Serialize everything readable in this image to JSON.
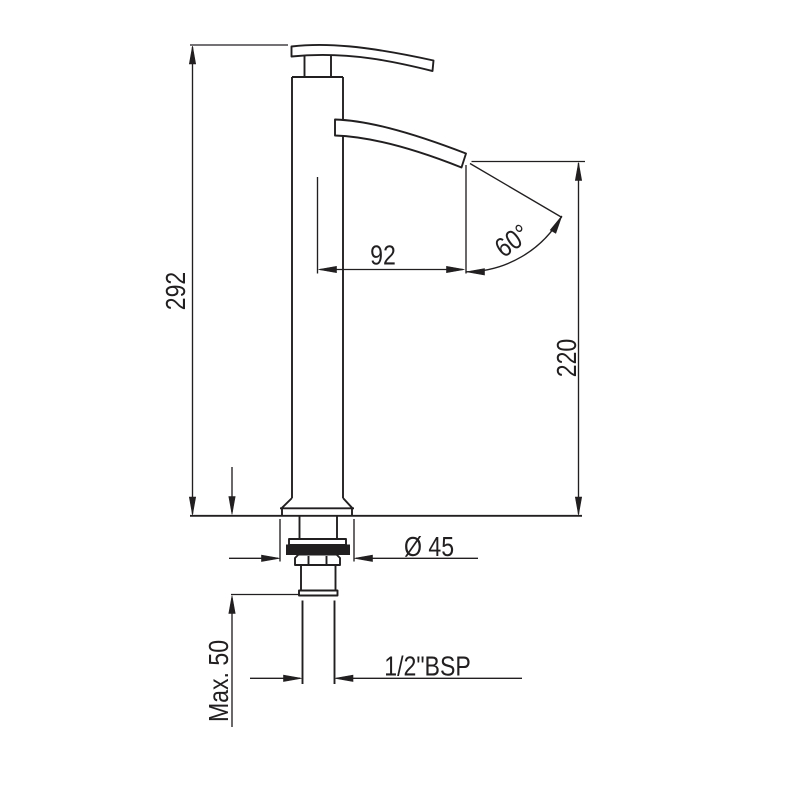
{
  "page": {
    "background": "#ffffff",
    "line_color": "#221f20"
  },
  "drawing": {
    "kind": "dimensioned side elevation of a tall single-lever basin mixer tap"
  },
  "dimensions": {
    "overall_height": "292",
    "spout_reach": "92",
    "spout_angle": "60°",
    "outlet_height": "220",
    "base_diameter": "Ø 45",
    "inlet_thread": "1/2\"BSP",
    "max_deck_thickness": "Max. 50"
  }
}
